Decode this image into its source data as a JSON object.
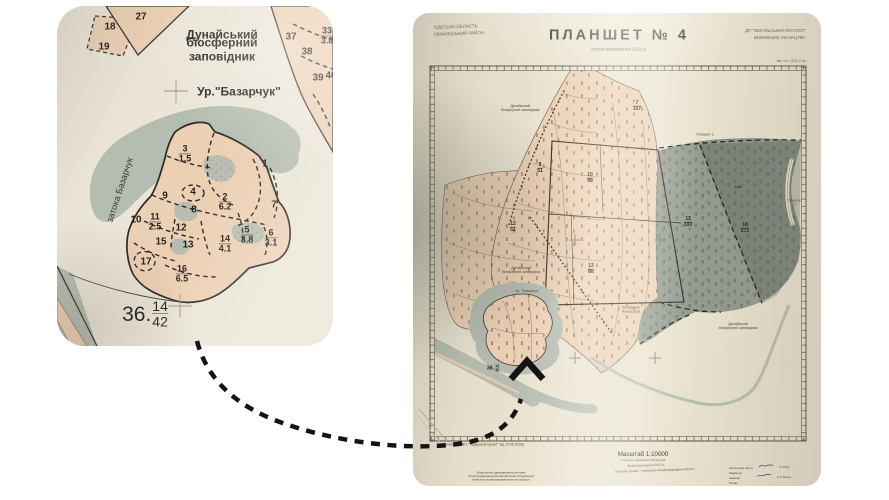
{
  "colors": {
    "page_bg": "#ffffff",
    "paper": "#e9e2cf",
    "inset_paper": "#eae5d7",
    "tan": "#ecd0b4",
    "tan_deep": "#e7c5a2",
    "water": "#b5bcb0",
    "marsh": "#939a8f",
    "marsh_dark": "#7e857c",
    "ink": "#26231e",
    "line": "#3c372e",
    "faint": "#8b857a",
    "arrow": "#141414"
  },
  "inset": {
    "labels": [
      {
        "t": "18",
        "x": 53,
        "y": 21,
        "fs": 10,
        "b": 1
      },
      {
        "t": "19",
        "x": 47,
        "y": 41,
        "fs": 10,
        "b": 1
      },
      {
        "t": "27",
        "x": 84,
        "y": 11,
        "fs": 10,
        "b": 1
      },
      {
        "t": "Дунайський",
        "x": 165,
        "y": 29,
        "fs": 12,
        "b": 1
      },
      {
        "t": "біосферний заповідник",
        "x": 165,
        "y": 44,
        "fs": 12,
        "b": 1
      },
      {
        "t": "37",
        "x": 234,
        "y": 31,
        "fs": 10,
        "b": 1
      },
      {
        "fr": [
          "33",
          "3.8"
        ],
        "x": 270,
        "y": 30,
        "fs": 9,
        "b": 1
      },
      {
        "t": "38",
        "x": 250,
        "y": 46,
        "fs": 10,
        "b": 1
      },
      {
        "t": "39",
        "x": 261,
        "y": 72,
        "fs": 10,
        "b": 1
      },
      {
        "t": "40",
        "x": 274,
        "y": 70,
        "fs": 10,
        "b": 1
      },
      {
        "t": "Ур.\"Базарчук\"",
        "x": 182,
        "y": 86,
        "fs": 12,
        "b": 1
      },
      {
        "t": "затока Базарчук",
        "x": 63,
        "y": 184,
        "fs": 9,
        "r": -72,
        "c": "#3c3c34"
      },
      {
        "fr": [
          "3",
          "1.5"
        ],
        "x": 128,
        "y": 148,
        "fs": 9,
        "b": 1
      },
      {
        "t": "1",
        "x": 208,
        "y": 158,
        "fs": 10,
        "b": 1
      },
      {
        "t": "9",
        "x": 108,
        "y": 190,
        "fs": 10,
        "b": 1
      },
      {
        "t": "4",
        "x": 136,
        "y": 186,
        "fs": 10,
        "b": 1
      },
      {
        "t": "8",
        "x": 137,
        "y": 204,
        "fs": 10,
        "b": 1
      },
      {
        "fr": [
          "2",
          "6.2"
        ],
        "x": 168,
        "y": 196,
        "fs": 9,
        "b": 1
      },
      {
        "t": "7",
        "x": 217,
        "y": 199,
        "fs": 10,
        "b": 1
      },
      {
        "t": "10",
        "x": 79,
        "y": 214,
        "fs": 10,
        "b": 1
      },
      {
        "fr": [
          "11",
          "2.5"
        ],
        "x": 98,
        "y": 216,
        "fs": 9,
        "b": 1
      },
      {
        "t": "12",
        "x": 124,
        "y": 222,
        "fs": 10,
        "b": 1
      },
      {
        "t": "15",
        "x": 104,
        "y": 236,
        "fs": 10,
        "b": 1
      },
      {
        "t": "13",
        "x": 131,
        "y": 239,
        "fs": 10,
        "b": 1
      },
      {
        "fr": [
          "14",
          "4.1"
        ],
        "x": 168,
        "y": 238,
        "fs": 9,
        "b": 1
      },
      {
        "fr": [
          "5",
          "3.8"
        ],
        "x": 190,
        "y": 229,
        "fs": 9,
        "b": 1
      },
      {
        "fr": [
          "6",
          "3.1"
        ],
        "x": 214,
        "y": 232,
        "fs": 9,
        "b": 1
      },
      {
        "t": "17",
        "x": 89,
        "y": 256,
        "fs": 10,
        "b": 1
      },
      {
        "fr": [
          "16",
          "6.5"
        ],
        "x": 125,
        "y": 268,
        "fs": 9,
        "b": 1
      },
      {
        "pre": "36.",
        "fr": [
          "14",
          "42"
        ],
        "x": 88,
        "y": 308,
        "fs": 14
      }
    ]
  },
  "map": {
    "title": "ПЛАНШЕТ № 4",
    "subtitle": "лісовпорядкування 2012 р.",
    "corner_top_left": "ОДЕСЬКА ОБЛАСТЬ\nІЗМАЇЛЬСЬКИЙ РАЙОН",
    "corner_top_right": "ДП \"ІЗМАЇЛЬСЬКИЙ ЛІСГОСП\"\nВИЛКІВСЬКЕ ЛІСНИЦТВО",
    "area_note": "заг. пл. 1102,2 га",
    "labels": [
      {
        "fr": [
          "7",
          "107"
        ],
        "x": 224,
        "y": 93,
        "fs": 5,
        "b": 1
      },
      {
        "fr": [
          "10",
          "98"
        ],
        "x": 177,
        "y": 165,
        "fs": 5,
        "b": 1
      },
      {
        "fr": [
          "9",
          "51"
        ],
        "x": 127,
        "y": 155,
        "fs": 5,
        "b": 1
      },
      {
        "fr": [
          "12",
          "51"
        ],
        "x": 100,
        "y": 214,
        "fs": 5,
        "b": 1
      },
      {
        "fr": [
          "13",
          "88"
        ],
        "x": 178,
        "y": 256,
        "fs": 5,
        "b": 1
      },
      {
        "fr": [
          "11",
          "193"
        ],
        "x": 275,
        "y": 209,
        "fs": 5,
        "b": 1,
        "c": "#1f241f"
      },
      {
        "fr": [
          "18",
          "272"
        ],
        "x": 332,
        "y": 215,
        "fs": 5,
        "b": 1,
        "c": "#1f241f"
      },
      {
        "t": "141",
        "x": 325,
        "y": 174,
        "fs": 4,
        "b": 1,
        "c": "#1f241f"
      },
      {
        "t": "Дунайський\nбіосферний заповідник",
        "x": 107,
        "y": 95,
        "fs": 3.6,
        "c": "#4a463a"
      },
      {
        "t": "Дунайський\nбіосферний заповідник",
        "x": 108,
        "y": 257,
        "fs": 3.6,
        "c": "#4a463a"
      },
      {
        "t": "Ур. \"Базарчук\"",
        "x": 114,
        "y": 278,
        "fs": 3.6,
        "c": "#4a463a"
      },
      {
        "t": "Дунайський\nбіосферний заповідник",
        "x": 325,
        "y": 313,
        "fs": 3.6,
        "c": "#4a463a"
      },
      {
        "t": "Вилківська\nміська рада",
        "x": 218,
        "y": 297,
        "fs": 3.4,
        "c": "#4a463a"
      },
      {
        "t": "Планшет 3",
        "x": 292,
        "y": 122,
        "fs": 3.4,
        "c": "#55513f"
      },
      {
        "t": "Планшет 5",
        "x": 382,
        "y": 190,
        "fs": 3.4,
        "c": "#55513f"
      },
      {
        "pre": "36.",
        "fr": [
          "14",
          "42"
        ],
        "x": 80,
        "y": 355,
        "fs": 3.6,
        "b": 1
      }
    ],
    "footer": [
      {
        "t": "Договір №3 ВО \"Укрдержліспроект\" від 14.05.2019р.",
        "x": 30,
        "y": 432,
        "fs": 3.4,
        "a": "l",
        "c": "#4d4a3e"
      },
      {
        "t": "Масштаб 1:10000",
        "x": 230,
        "y": 441,
        "fs": 6.2
      },
      {
        "t": "в одному сантиметрі 100 метрів",
        "x": 230,
        "y": 448,
        "fs": 3,
        "c": "#555042"
      },
      {
        "t": "Зйомка виконана в 2012 р.",
        "x": 233,
        "y": 453,
        "fs": 3,
        "c": "#555042",
        "r": -2
      },
      {
        "t": "Планова основа — матеріали лісовпорядкування 2012 р.",
        "x": 242,
        "y": 458,
        "fs": 3,
        "c": "#555042",
        "r": -2
      },
      {
        "t": "Розроблено державним проектним\nлісовпорядкувальним виробничим об'єднанням\nКиївська лісовпорядкувальна експедиція",
        "x": 88,
        "y": 464,
        "fs": 3,
        "c": "#4d4a3e"
      },
      {
        "t": "Начальник партії",
        "x": 316,
        "y": 456,
        "fs": 3,
        "a": "l",
        "c": "#44403a"
      },
      {
        "t": "Т.І.Гібуч",
        "x": 366,
        "y": 455,
        "fs": 3,
        "a": "l",
        "c": "#44403a"
      },
      {
        "t": "Редактор",
        "x": 316,
        "y": 461,
        "fs": 3,
        "a": "l",
        "c": "#44403a"
      },
      {
        "t": "Інженер",
        "x": 316,
        "y": 466,
        "fs": 3,
        "a": "l",
        "c": "#44403a"
      },
      {
        "t": "А.С.Рачик",
        "x": 364,
        "y": 465,
        "fs": 3,
        "a": "l",
        "c": "#44403a"
      },
      {
        "t": "Технік",
        "x": 316,
        "y": 471,
        "fs": 3,
        "a": "l",
        "c": "#44403a"
      }
    ]
  }
}
